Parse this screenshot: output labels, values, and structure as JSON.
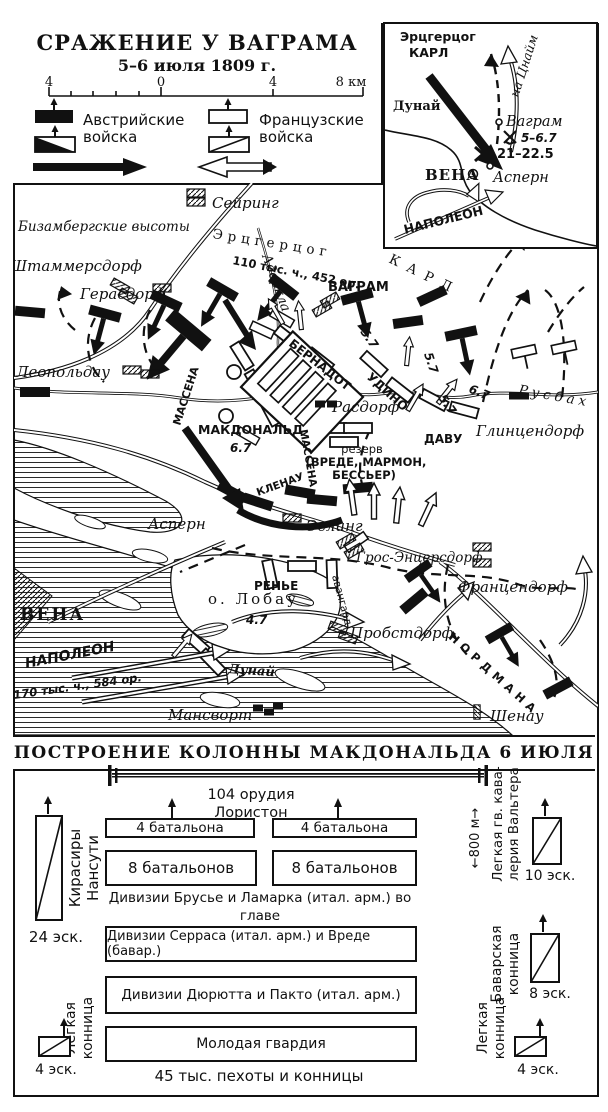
{
  "title": {
    "line1": "СРАЖЕНИЕ У ВАГРАМА",
    "line2": "5–6 июля 1809 г."
  },
  "scale_bar": {
    "t1": "4",
    "t2": "0",
    "t3": "4",
    "t4": "8 км"
  },
  "legend": {
    "austrian_line1": "Австрийские",
    "austrian_line2": "войска",
    "french_line1": "Французские",
    "french_line2": "войска"
  },
  "inset": {
    "erzherzog": "Эрцгерцог",
    "karl": "КАРЛ",
    "na_znaim": "на Цнайм",
    "dunay": "Дунай",
    "wagram": "Ваграм",
    "battle_wagram": "5–6.7",
    "battle_aspern": "21–22.5",
    "vena": "ВЕНА",
    "aspern": "Асперн",
    "napoleon": "НАПОЛЕОН"
  },
  "map": {
    "labels": {
      "seyring": "Сейринг",
      "bisamberg": "Бизамбергские высоты",
      "erzherzog": "Эрцгерцог",
      "karl": "КАРЛ",
      "strength_a": "110 тыс. ч., 452 ор.",
      "aderklaa": "Адеркла",
      "stammersdorf": "Штаммерсдорф",
      "gerasdorf": "Герасдорф",
      "wagram": "ВАГРАМ",
      "leopoldau": "Леопольдау",
      "bernadotte": "БЕРНАДОТ",
      "oudinot": "УДИНО",
      "d57a": "5.7",
      "d57b": "5.7",
      "d57c": "5.7",
      "d67a": "6.7",
      "d67b": "6.7",
      "d47": "4.7",
      "macdonald": "МАКДОНАЛЬД",
      "massena1": "МАССЕНА",
      "massena2": "МАССЕНА",
      "klenau": "КЛЕНАУ",
      "rasdorf": "Расдорф",
      "reserve1": "резерв",
      "reserve2": "(ВРЕДЕ, МАРМОН,",
      "reserve3": "БЕССЬЕР)",
      "davout": "ДАВУ",
      "glinzendorf": "Глинцендорф",
      "russbach": "Русбах",
      "aspern": "Асперн",
      "essling": "Эслинг",
      "gross_enzersdorf": "Грос-Энцерсдорф",
      "franzensdorf": "Францендорф",
      "reynier": "РЕНЬЕ",
      "lobau": "о. Лобау",
      "avangard": "авангард",
      "probstdorf": "Пробстдорф",
      "nordmann": "НОРДМАНА",
      "vena": "ВЕНА",
      "napoleon": "НАПОЛЕОН",
      "strength_f": "170 тыс. ч., 584 ор.",
      "dunay": "Дунай",
      "mansvort": "Мансворт",
      "schoenau": "Шенау"
    }
  },
  "formation": {
    "header": "ПОСТРОЕНИЕ КОЛОННЫ МАКДОНАЛЬДА 6 ИЮЛЯ",
    "guns": "104 орудия",
    "loriston": "Лористон",
    "bn4a": "4 батальона",
    "bn4b": "4 батальона",
    "bn8a": "8 батальонов",
    "bn8b": "8 батальонов",
    "caption1": "Дивизии Брусье и Ламарка (итал. арм.) во главе",
    "caption2": "с Макдональдом (8 тыс.)",
    "serras": "Дивизии Серраса (итал. арм.) и Вреде (бавар.)",
    "durutte": "Дивизии Дюрютта и Пакто (итал. арм.)",
    "young_guard": "Молодая гвардия",
    "total": "45 тыс. пехоты и конницы",
    "nansouty1": "Кирасиры",
    "nansouty2": "Нансути",
    "esk24": "24 эск.",
    "walther1": "Легкая гв. кава-",
    "walther2": "лерия Вальтера",
    "esk10": "10 эск.",
    "m800": "←800 м→",
    "bavarian1": "Баварская",
    "bavarian2": "конница",
    "esk8": "8 эск.",
    "lightL1": "Легкая",
    "lightL2": "конница",
    "esk4l": "4 эск.",
    "lightR1": "Легкая",
    "lightR2": "конница",
    "esk4r": "4 эск."
  },
  "colors": {
    "ink": "#111111",
    "paper": "#ffffff"
  }
}
